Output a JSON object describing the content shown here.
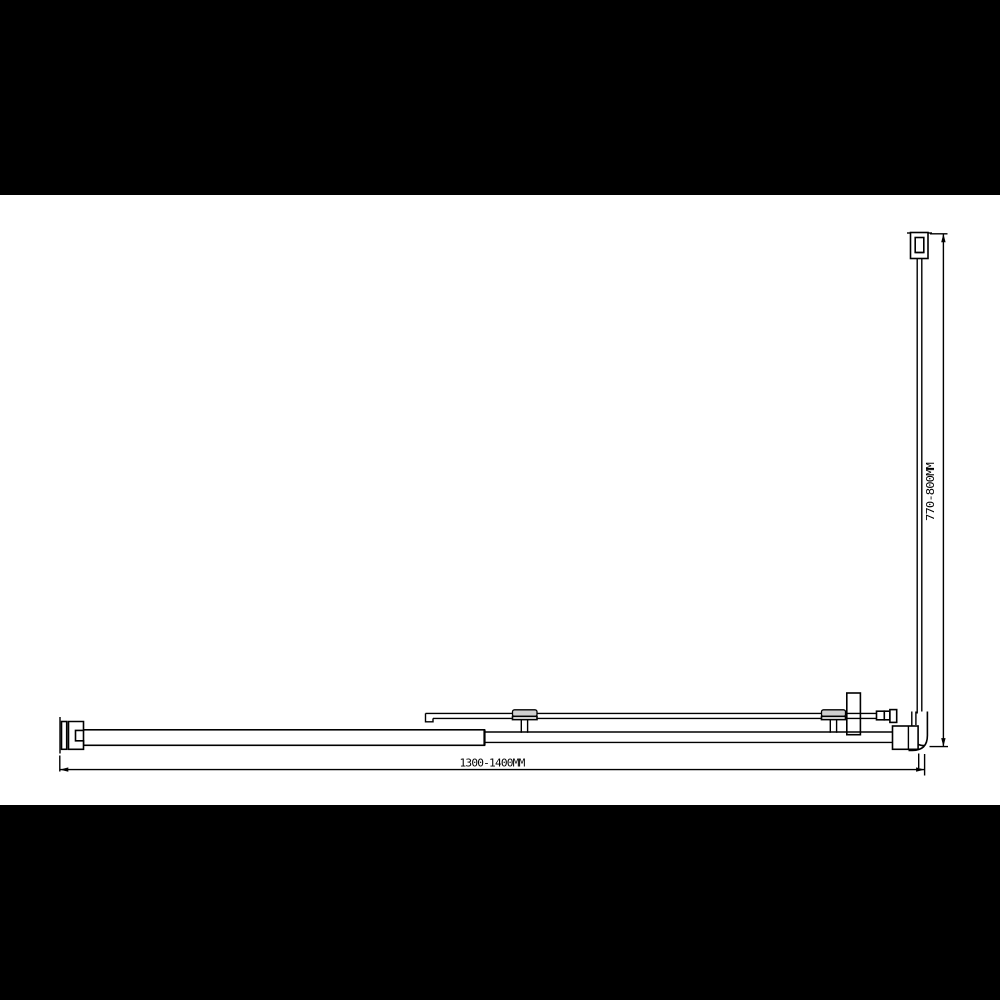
{
  "drawing": {
    "colors": {
      "letterbox": "#000000",
      "paper": "#ffffff",
      "line": "#000000",
      "roller_pad_fill": "#cfcfcf"
    }
  },
  "dimensions": {
    "width_label": "1300-1400MM",
    "height_label": "770-800MM"
  }
}
